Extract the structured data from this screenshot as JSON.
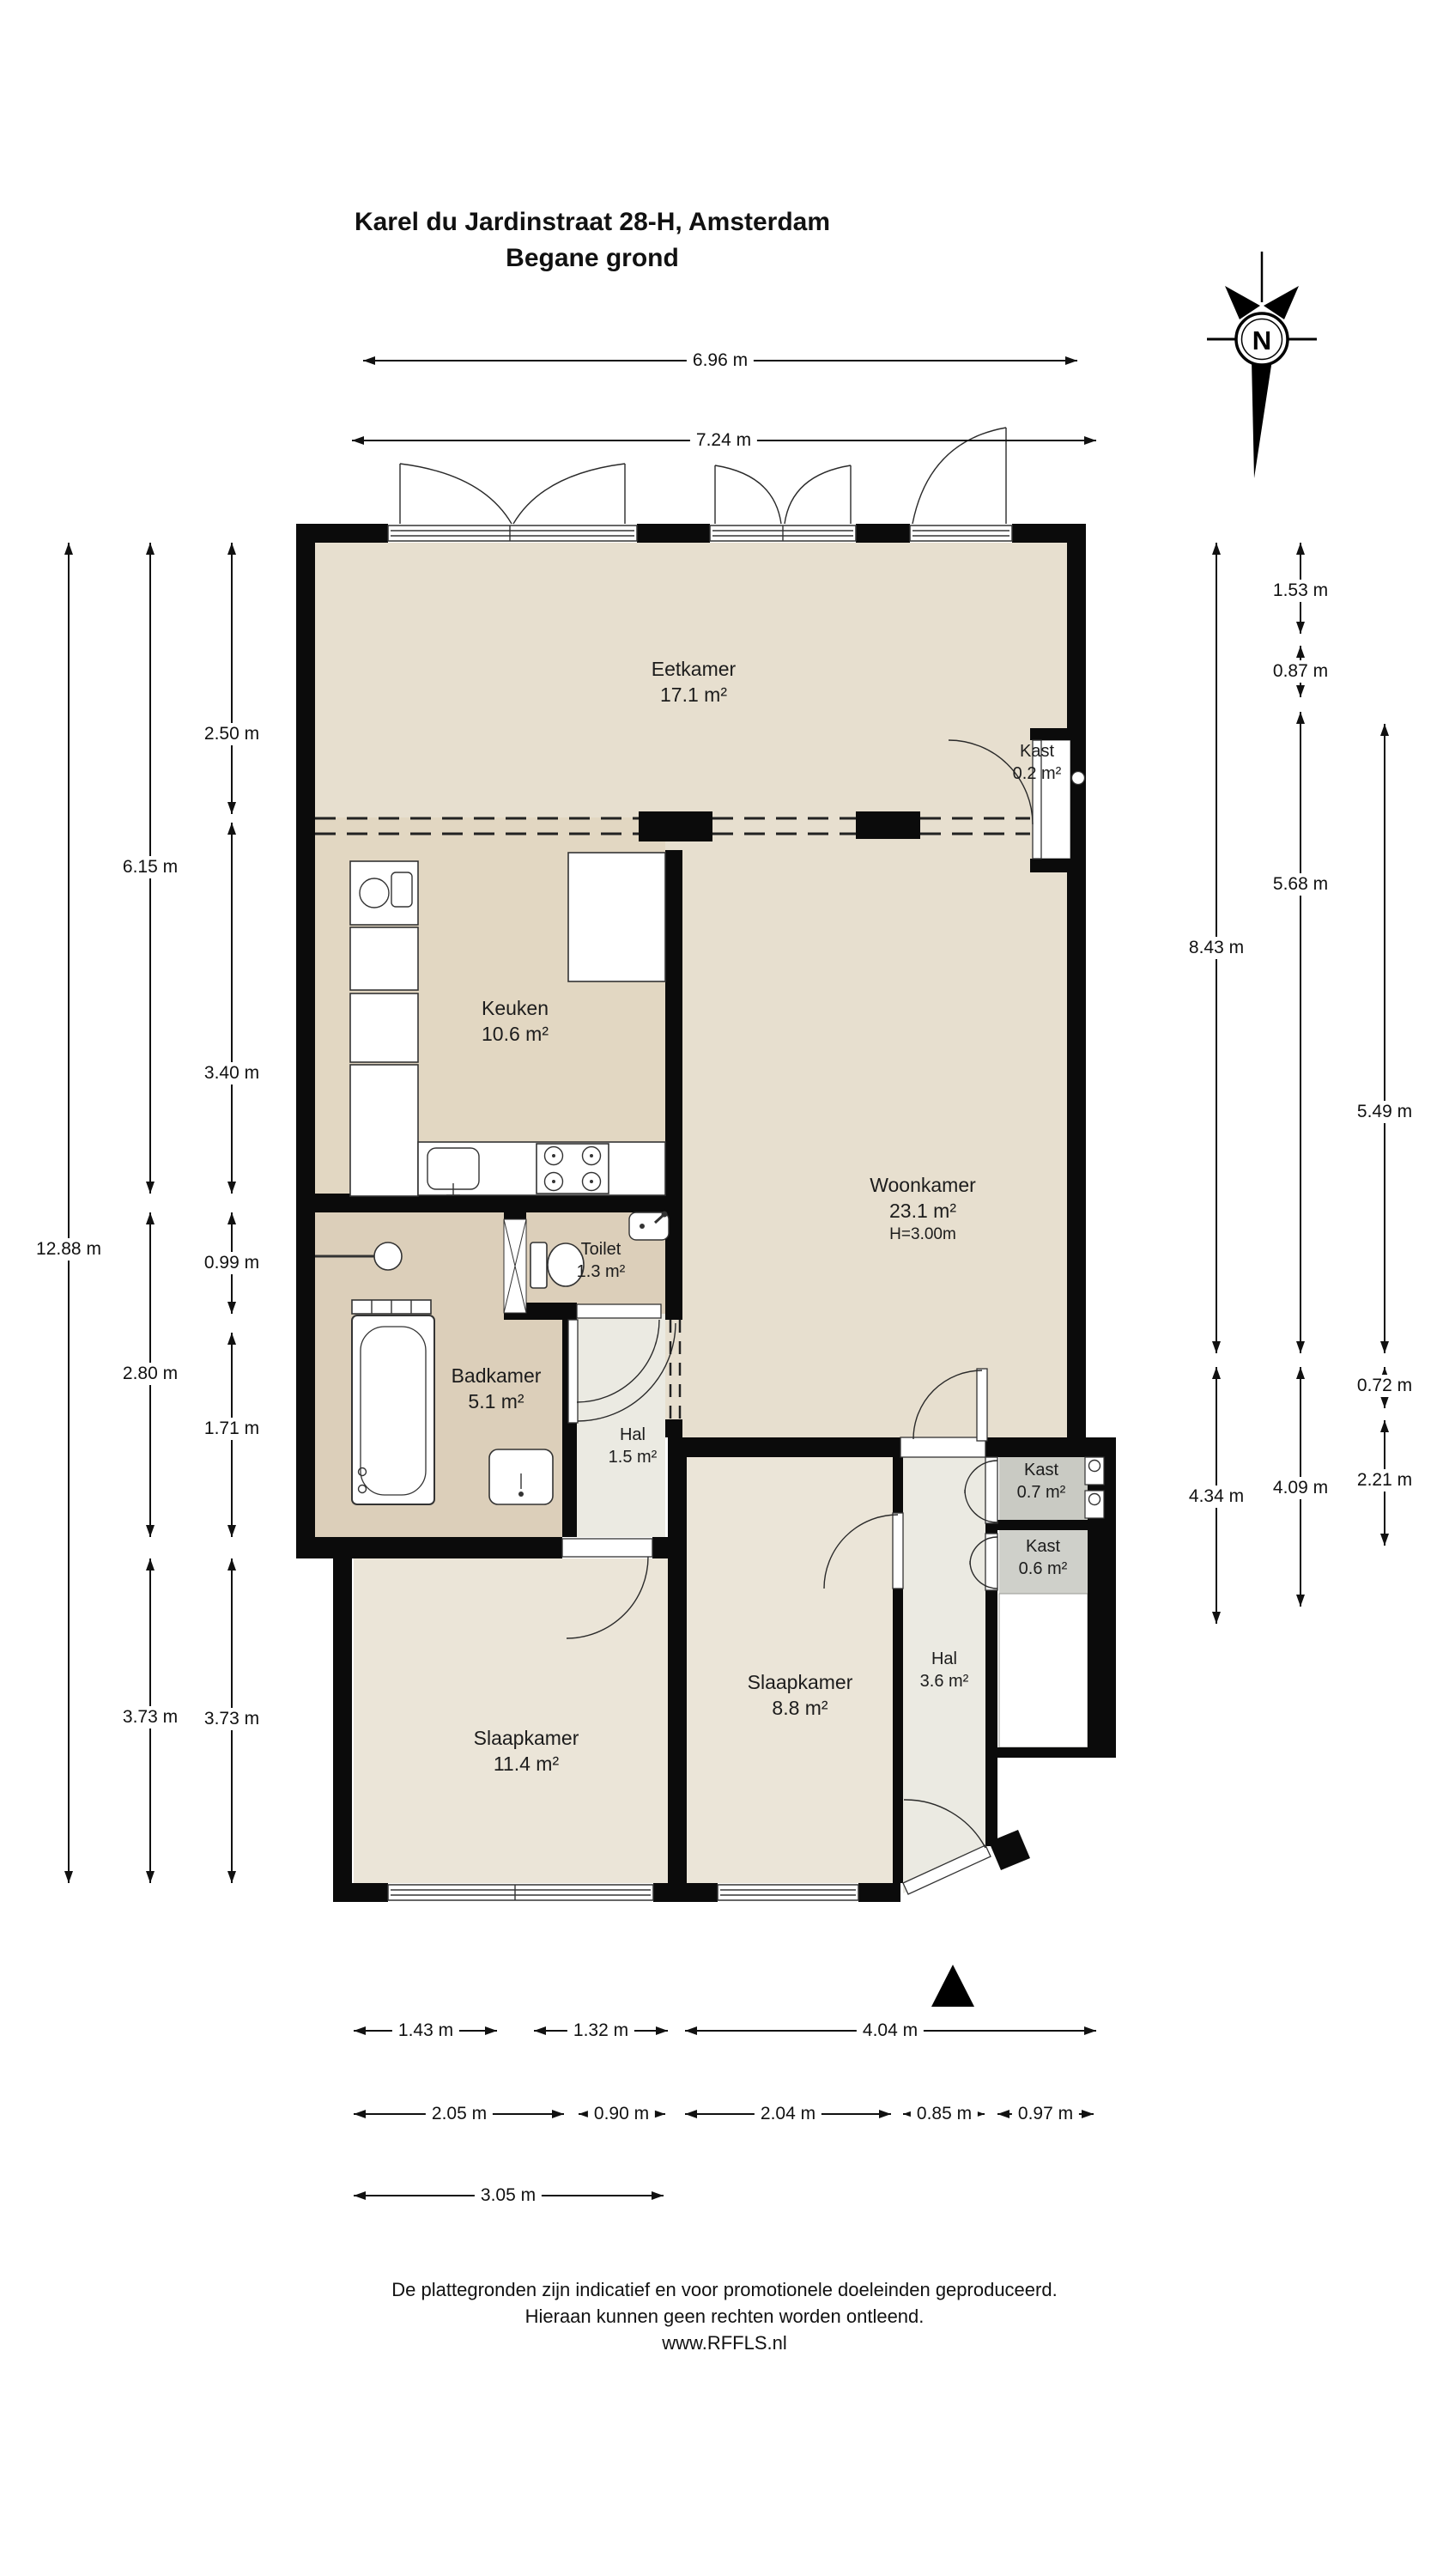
{
  "title": {
    "line1": "Karel du Jardinstraat 28-H, Amsterdam",
    "line2": "Begane grond"
  },
  "compass": {
    "letter": "N"
  },
  "rooms": {
    "eetkamer": {
      "name": "Eetkamer",
      "area": "17.1 m²"
    },
    "kast_eetkamer": {
      "name": "Kast",
      "area": "0.2 m²"
    },
    "keuken": {
      "name": "Keuken",
      "area": "10.6 m²"
    },
    "woonkamer": {
      "name": "Woonkamer",
      "area": "23.1 m²",
      "ceiling": "H=3.00m"
    },
    "toilet": {
      "name": "Toilet",
      "area": "1.3 m²"
    },
    "badkamer": {
      "name": "Badkamer",
      "area": "5.1 m²"
    },
    "hal_klein": {
      "name": "Hal",
      "area": "1.5 m²"
    },
    "kast_07": {
      "name": "Kast",
      "area": "0.7 m²"
    },
    "kast_06": {
      "name": "Kast",
      "area": "0.6 m²"
    },
    "slaapkamer_groot": {
      "name": "Slaapkamer",
      "area": "11.4 m²"
    },
    "slaapkamer_klein": {
      "name": "Slaapkamer",
      "area": "8.8 m²"
    },
    "hal_entree": {
      "name": "Hal",
      "area": "3.6 m²"
    }
  },
  "dimensions": {
    "top": [
      {
        "label": "6.96 m"
      },
      {
        "label": "7.24 m"
      }
    ],
    "left": [
      {
        "label": "12.88 m"
      },
      {
        "label": "6.15 m"
      },
      {
        "label": "2.80 m"
      },
      {
        "label": "3.73 m"
      },
      {
        "label": "2.50 m"
      },
      {
        "label": "3.40 m"
      },
      {
        "label": "0.99 m"
      },
      {
        "label": "1.71 m"
      },
      {
        "label": "3.73 m"
      }
    ],
    "right": [
      {
        "label": "8.43 m"
      },
      {
        "label": "4.34 m"
      },
      {
        "label": "1.53 m"
      },
      {
        "label": "0.87 m"
      },
      {
        "label": "5.68 m"
      },
      {
        "label": "4.09 m"
      },
      {
        "label": "5.49 m"
      },
      {
        "label": "0.72 m"
      },
      {
        "label": "2.21 m"
      }
    ],
    "bottom": [
      {
        "label": "1.43 m"
      },
      {
        "label": "1.32 m"
      },
      {
        "label": "4.04 m"
      },
      {
        "label": "2.05 m"
      },
      {
        "label": "0.90 m"
      },
      {
        "label": "2.04 m"
      },
      {
        "label": "0.85 m"
      },
      {
        "label": "0.97 m"
      },
      {
        "label": "3.05 m"
      }
    ]
  },
  "footer": {
    "line1": "De plattegronden zijn indicatief en voor promotionele doeleinden geproduceerd.",
    "line2": "Hieraan kunnen geen rechten worden ontleend.",
    "line3": "www.RFFLS.nl"
  },
  "colors": {
    "wall": "#0b0b0b",
    "floor_living": "#e7dfcf",
    "floor_kitchen": "#e2d7c2",
    "floor_bath": "#dccfba",
    "floor_bedroom": "#ebe5d8",
    "floor_hall": "#ebeae2",
    "closet_grey_1": "#c9cac3",
    "closet_grey_2": "#cfd0ca",
    "background": "#ffffff"
  }
}
